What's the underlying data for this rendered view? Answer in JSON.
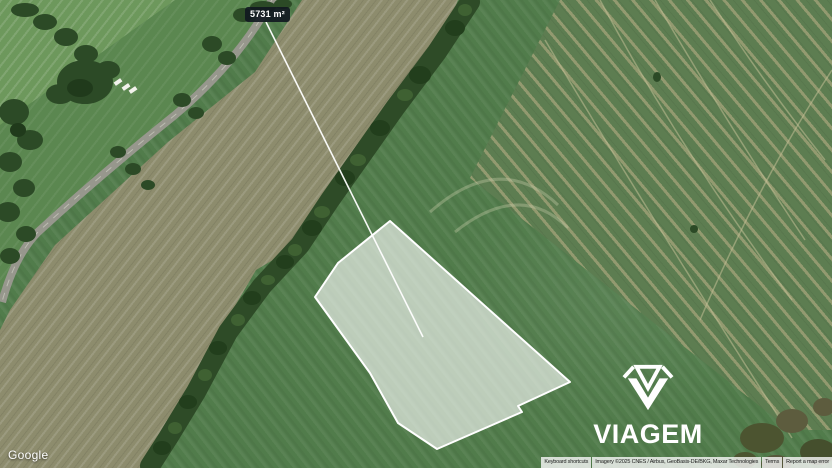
{
  "map": {
    "area_label": "5731 m²",
    "parcel": {
      "points": "390,221 570,382 518,406 522,412 437,449 398,423 370,373 315,297 338,263",
      "leader_line_points": "266,22 423,337",
      "fill_color": "rgba(255,255,255,0.62)",
      "stroke_color": "#ffffff"
    },
    "label_colors": {
      "background": "rgba(17,23,32,0.9)",
      "text": "#ffffff"
    }
  },
  "watermark": {
    "brand": "VIAGEM",
    "icon": "gem-icon",
    "color": "#ffffff"
  },
  "google": {
    "logo_text": "Google"
  },
  "attribution": {
    "keyboard_shortcuts": "Keyboard shortcuts",
    "imagery": "Imagery ©2025 CNES / Airbus, GeoBasis-DE/BKG, Maxar Technologies",
    "terms": "Terms",
    "report_error": "Report a map error"
  }
}
